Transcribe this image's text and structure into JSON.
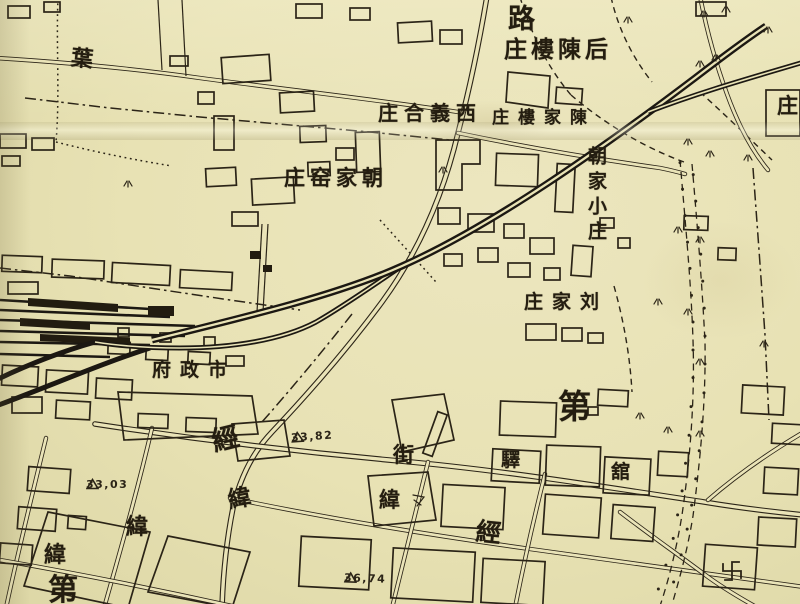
{
  "paper_color": "#e8e2b4",
  "ink_color": "#2b2417",
  "labels": [
    {
      "text": "路"
    },
    {
      "text": "庄樓陳后"
    },
    {
      "text": "庄合義西"
    },
    {
      "text": "庄樓家陳"
    },
    {
      "text": "庄窑家朝"
    },
    {
      "text": "朝家小庄",
      "orientation": "vertical"
    },
    {
      "text": "庄家刘"
    },
    {
      "text": "府政市"
    },
    {
      "text": "經"
    },
    {
      "text": "緯"
    },
    {
      "text": "緯"
    },
    {
      "text": "緯"
    },
    {
      "text": "第"
    },
    {
      "text": "街"
    },
    {
      "text": "驛"
    },
    {
      "text": "舘"
    },
    {
      "text": "第"
    },
    {
      "text": "緯"
    },
    {
      "text": "經"
    },
    {
      "text": "葉"
    },
    {
      "text": "庄"
    }
  ],
  "elevation_markers": [
    {
      "symbol": "△",
      "value": "33,82"
    },
    {
      "symbol": "△",
      "value": "33,03"
    },
    {
      "symbol": "△",
      "value": "36,74"
    }
  ],
  "symbols": {
    "temple_swastika": "卍",
    "vegetation_tuft": "屮",
    "triangulation_point": "△"
  }
}
